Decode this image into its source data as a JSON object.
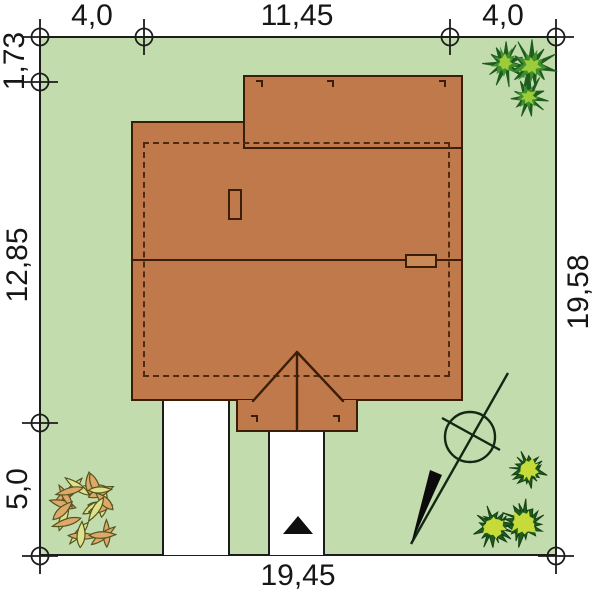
{
  "plan": {
    "dimensions": {
      "top_left": "4,0",
      "top_center": "11,45",
      "top_right": "4,0",
      "left_upper": "1,73",
      "left_middle": "12,85",
      "left_lower": "5,0",
      "right_side": "19,58",
      "bottom": "19,45"
    },
    "icons": [
      "survey-marker-icon",
      "north-arrow-icon",
      "entrance-arrow-icon",
      "conifer-icon",
      "bush-icon",
      "shrub-icon",
      "chimney-icon",
      "roof-vent-icon"
    ],
    "colors": {
      "plot_green": "#c3dcae",
      "roof_fill": "#c0794a",
      "roof_outline": "#3a1e07",
      "wall_dashed": "#4f2a10",
      "chimney_fill": "#ca8a58",
      "path_white": "#ffffff",
      "line_black": "#1c1c1c",
      "conifer_dark": "#1e5c1e",
      "conifer_mid": "#3f8f2f",
      "conifer_light": "#9ccc3a",
      "bush_light": "#c6da3a",
      "leaf_yellow": "#dce28e",
      "leaf_orange": "#dea86a",
      "leaf_outline": "#55551e"
    }
  }
}
